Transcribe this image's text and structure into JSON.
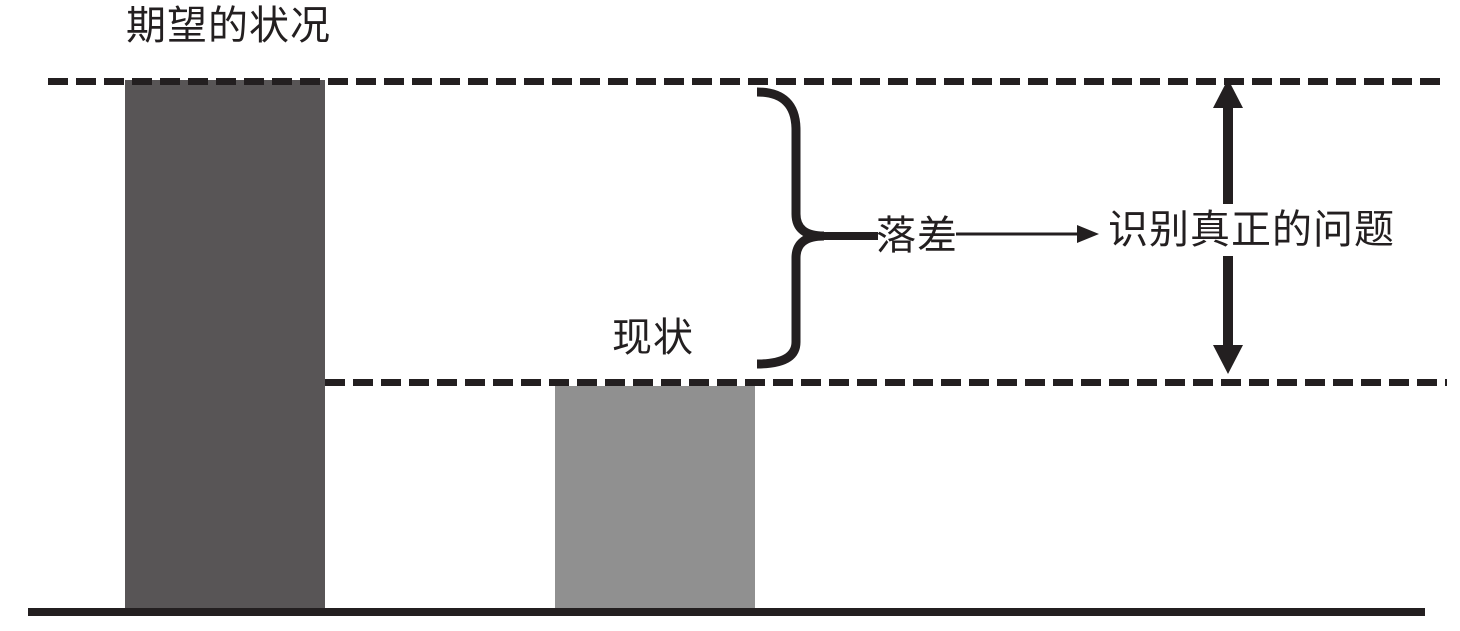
{
  "labels": {
    "expected_state": "期望的状况",
    "current_state": "现状",
    "gap": "落差",
    "identify_problem": "识别真正的问题"
  },
  "colors": {
    "ink": "#231f20",
    "expected_bar": "#585556",
    "current_bar": "#909090",
    "background": "#ffffff"
  },
  "diagram": {
    "type": "gap-analysis",
    "bars": [
      {
        "name": "期望的状况",
        "level": "high",
        "color": "#585556"
      },
      {
        "name": "现状",
        "level": "low",
        "color": "#909090"
      }
    ],
    "relations": [
      {
        "from": "期望的状况",
        "to": "现状",
        "label": "落差"
      },
      {
        "from": "落差",
        "to": "识别真正的问题",
        "connector": "arrow"
      }
    ]
  }
}
